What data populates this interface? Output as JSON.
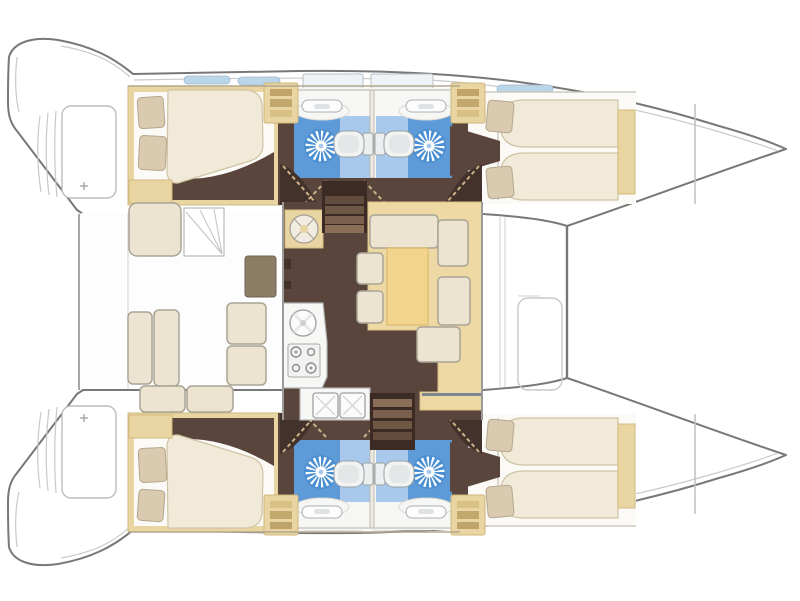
{
  "diagram": {
    "label": "Catamaran interior layout floor plan seen from above, bow to the right",
    "vessel_type": "sailing catamaran",
    "layout_version": "4 cabins / 4 heads"
  },
  "colors": {
    "hull_line": "#787878",
    "deck_line": "#c9c9c9",
    "wall_line": "#9b9b9b",
    "floor": "#5a453c",
    "floor_dark": "#43322b",
    "stair_dark": "#3c2b25",
    "stair_tread": "#8a6e58",
    "wood": "#e9d5a1",
    "wood_light": "#eed9a4",
    "table_yellow": "#f2d48c",
    "cushion": "#ece4d1",
    "cushion_line": "#aaa496",
    "mattress": "#f1ead9",
    "mattress_line": "#cfc3a4",
    "pillow": "#d9cab0",
    "pillow_line": "#b5a88e",
    "bath_blue": "#5e9ad8",
    "bath_blue_light": "#a9c9ec",
    "shower_blue": "#4a8fd2",
    "fixture": "#f4f4f2",
    "fixture_line": "#9aa0a4",
    "window_blue": "#bcd6e9",
    "hatch_fill": "#eef3f7",
    "counter": "#f7f7f5",
    "cockpit_table": "#8d7d64",
    "sole": "#fdfdfd",
    "cabin_bg": "#fbfaf7",
    "bath_bg": "#f6f6f4"
  },
  "areas": {
    "cockpit": {
      "name": "Aft cockpit",
      "features": [
        "helm seat",
        "deck steps",
        "cockpit table",
        "L-shaped bench seating"
      ]
    },
    "saloon": {
      "name": "Saloon",
      "features": [
        "round chart table",
        "L-shaped settee",
        "dining table",
        "two stools",
        "lounge seat"
      ]
    },
    "galley": {
      "name": "Galley",
      "features": [
        "round sink",
        "four-burner stove",
        "double sink",
        "worktop"
      ]
    },
    "port_hull": {
      "name": "Port hull (top)",
      "rooms": [
        "aft double cabin",
        "two bathrooms with shower, toilet and washbasin",
        "forward cabin with two berths"
      ]
    },
    "starboard_hull": {
      "name": "Starboard hull (bottom)",
      "rooms": [
        "aft double cabin",
        "two bathrooms with shower, toilet and washbasin",
        "forward cabin with two berths"
      ]
    },
    "foredeck": {
      "name": "Foredeck",
      "features": [
        "trampoline",
        "deck hatches",
        "forward locker"
      ]
    },
    "sterns": {
      "name": "Transoms",
      "features": [
        "swim platforms",
        "transom steps"
      ]
    }
  }
}
